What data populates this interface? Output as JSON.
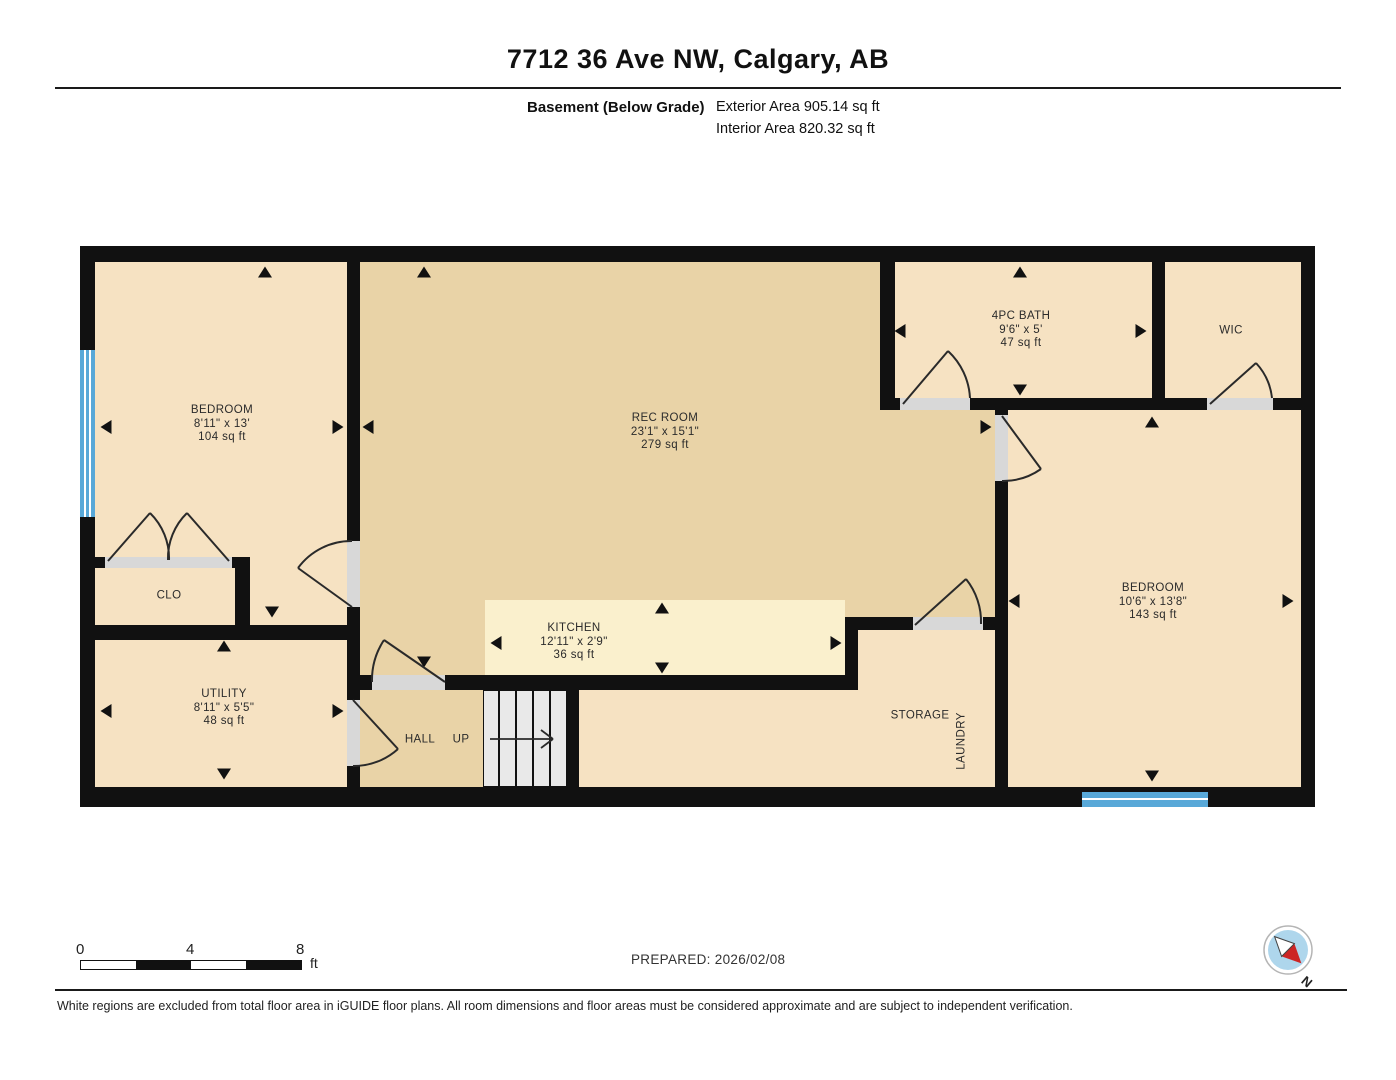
{
  "header": {
    "title": "7712 36 Ave NW, Calgary, AB",
    "floor_label": "Basement (Below Grade)",
    "exterior_area": "Exterior Area 905.14 sq ft",
    "interior_area": "Interior Area 820.32 sq ft"
  },
  "rooms": {
    "bedroom_left": {
      "name": "BEDROOM",
      "dims": "8'11\" x 13'",
      "area": "104 sq ft"
    },
    "rec_room": {
      "name": "REC ROOM",
      "dims": "23'1\" x 15'1\"",
      "area": "279 sq ft"
    },
    "bath": {
      "name": "4PC BATH",
      "dims": "9'6\" x 5'",
      "area": "47 sq ft"
    },
    "wic": {
      "name": "WIC"
    },
    "bedroom_right": {
      "name": "BEDROOM",
      "dims": "10'6\" x 13'8\"",
      "area": "143 sq ft"
    },
    "kitchen": {
      "name": "KITCHEN",
      "dims": "12'11\" x 2'9\"",
      "area": "36 sq ft"
    },
    "clo": {
      "name": "CLO"
    },
    "utility": {
      "name": "UTILITY",
      "dims": "8'11\" x 5'5\"",
      "area": "48 sq ft"
    },
    "hall": {
      "name": "HALL"
    },
    "up": {
      "name": "UP"
    },
    "storage": {
      "name": "STORAGE"
    },
    "laundry": {
      "name": "LAUNDRY"
    }
  },
  "scale_bar": {
    "start": "0",
    "mid": "4",
    "end": "8",
    "unit": "ft"
  },
  "footer": {
    "prepared": "PREPARED: 2026/02/08",
    "disclaimer": "White regions are excluded from total floor area in iGUIDE floor plans. All room dimensions and floor areas must be considered approximate and are subject to independent verification.",
    "compass_label": "N"
  },
  "colors": {
    "wall": "#111111",
    "room_peach": "#f6e2c2",
    "room_tan": "#e9d3a7",
    "kitchen_cream": "#faf0cd",
    "door_gray": "#d8d8d8",
    "stair_gray": "#e9e9e9",
    "window_blue": "#58a8d8",
    "compass_red": "#cc2525",
    "compass_blue": "#aed6ec"
  }
}
